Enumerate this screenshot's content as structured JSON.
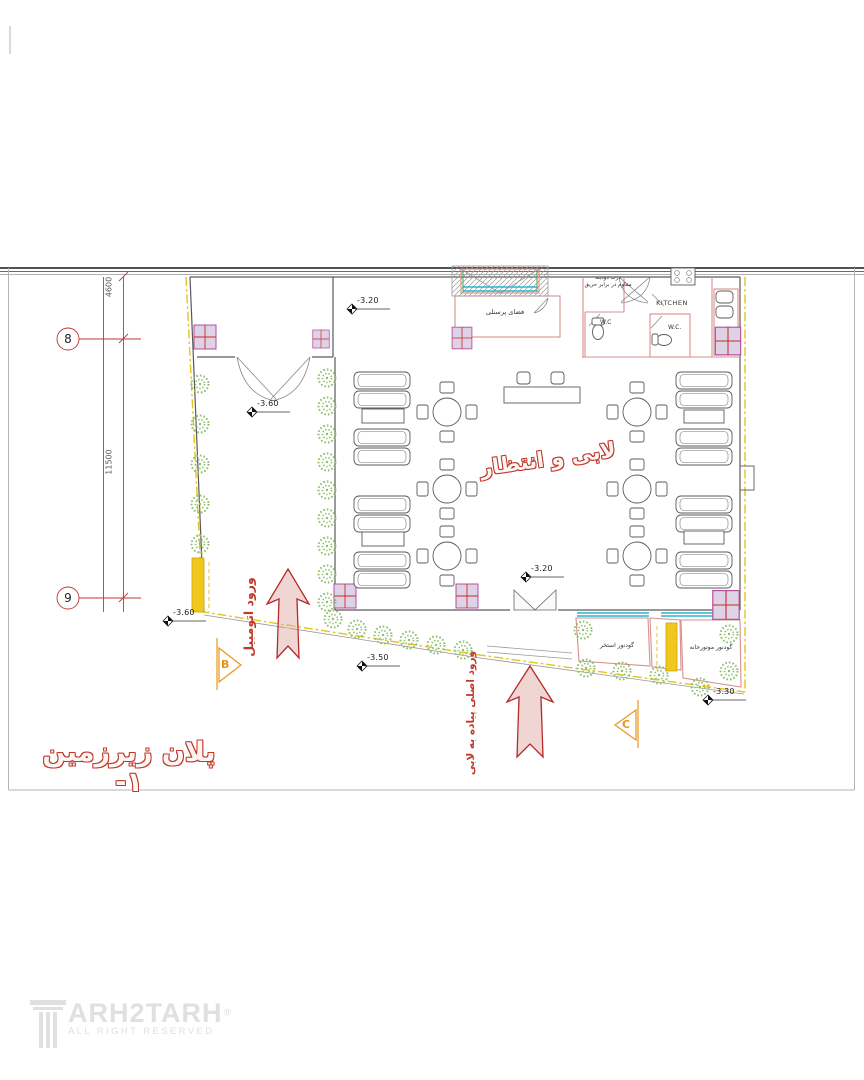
{
  "document": {
    "type": "architectural basement floor plan",
    "title": "پلان زیرزمین ۱-"
  },
  "logo": {
    "brand": "ARH2TARH",
    "registered": "®",
    "tagline": "ALL RIGHT RESERVED"
  },
  "grid_axes": {
    "bubble_8": "8",
    "bubble_9": "9",
    "dim_top": "4600",
    "dim_bottom": "11500"
  },
  "rooms": {
    "lobby": "لابی و انتظار",
    "staff_room": "فضای پرسنلی",
    "kitchen": "KITCHEN",
    "wc_left": "W.C",
    "wc_right": "W.C.",
    "lightwell_pool": "گودنور استخر",
    "lightwell_mech": "گودنور موتورخانه"
  },
  "annotations": {
    "door_note_line1": "درب دودبند",
    "door_note_line2": "مقاوم در برابر حریق"
  },
  "entrances": {
    "car": "ورود اتومبیل",
    "pedestrian": "ورود اصلی پیاده به لابی"
  },
  "levels": [
    {
      "value": "-3.20"
    },
    {
      "value": "-3.60"
    },
    {
      "value": "-3.20"
    },
    {
      "value": "-3.60"
    },
    {
      "value": "-3.50"
    },
    {
      "value": "-3.30"
    }
  ],
  "sections": {
    "b": "B",
    "c": "C"
  },
  "colors": {
    "accent_red": "#c0392b",
    "dim_red": "#c13636",
    "pink_wall": "#d88f8f",
    "column_fill": "#ded2e6",
    "column_stroke": "#b4509c",
    "tree_green": "#8bbf6a",
    "property_yellow": "#e3c51d",
    "bar_yellow": "#f2c71d",
    "window_cyan": "#2ab7cf",
    "section_orange": "#e8951d",
    "logo_gray": "#e0e0e0"
  }
}
